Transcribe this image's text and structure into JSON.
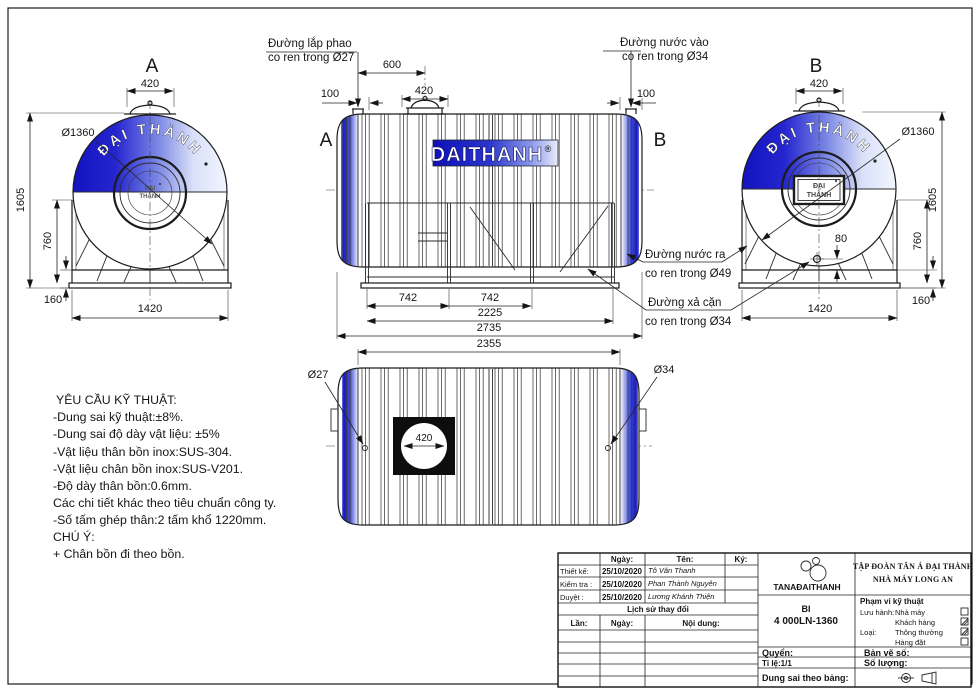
{
  "colors": {
    "brand_blue_dark": "#1212c0",
    "brand_blue_mid": "#3c46d8",
    "brand_blue_light": "#dfe6fb",
    "line": "#1c1c1c"
  },
  "views": {
    "side_a": {
      "letter": "A",
      "dim_manhole": "420",
      "dia_label": "Ø1360",
      "dim_height": "1605",
      "dim_stand": "760",
      "dim_base": "160",
      "dim_width": "1420",
      "arc_brand": "ĐẠI THÀNH",
      "hub_top": "ĐẠI",
      "hub_bottom": "THÀNH"
    },
    "side_b": {
      "letter": "B",
      "dim_manhole": "420",
      "dia_label": "Ø1360",
      "dim_height": "1605",
      "dim_stand": "760",
      "dim_base": "160",
      "dim_width": "1420",
      "dim_drain": "80",
      "arc_brand": "ĐẠI THÀNH",
      "hub_top": "ĐẠI",
      "hub_bottom": "THÀNH"
    },
    "elevation": {
      "letter_left": "A",
      "letter_right": "B",
      "dim_float": "600",
      "dim_left": "100",
      "dim_manhole": "420",
      "dim_right": "100",
      "dim_seg1": "742",
      "dim_seg2": "742",
      "dim_stand": "2225",
      "dim_total": "2735",
      "brand": "DAITHANH",
      "reg": "®"
    },
    "plan": {
      "dim_body": "2355",
      "dia_left": "Ø27",
      "dia_right": "Ø34",
      "dim_manhole": "420"
    }
  },
  "callouts": {
    "float_line1": "Đường lắp phao",
    "float_line2": "co ren trong Ø27",
    "inlet_line1": "Đường nước vào",
    "inlet_line2": "co ren trong Ø34",
    "outlet_line1": "Đường nước ra",
    "outlet_line2": "co ren trong Ø49",
    "drain_line1": "Đường xả cặn",
    "drain_line2": "co ren trong Ø34"
  },
  "tech_note": {
    "title": "YÊU CẦU KỸ THUẬT:",
    "items": [
      "-Dung sai kỹ thuật:±8%.",
      "-Dung sai độ dày vật liệu: ±5%",
      "-Vật liệu thân bồn inox:SUS-304.",
      "-Vật liệu chân bồn inox:SUS-V201.",
      "-Độ dày thân bồn:0.6mm.",
      "Các chi tiết khác theo tiêu chuẩn công ty.",
      "-Số tấm ghép thân:2 tấm khổ 1220mm."
    ],
    "attention": "CHÚ Ý:",
    "attention_items": [
      "+ Chân bồn đi theo bồn."
    ]
  },
  "title_block": {
    "approval": {
      "col_date": "Ngày:",
      "col_name": "Tên:",
      "col_sign": "Ký:",
      "row1_label": "Thiết kế:",
      "row1_date": "25/10/2020",
      "row1_name": "Tô Văn Thanh",
      "row2_label": "Kiểm tra :",
      "row2_date": "25/10/2020",
      "row2_name": "Phan Thành Nguyên",
      "row3_label": "Duyệt :",
      "row3_date": "25/10/2020",
      "row3_name": "Lương Khánh Thiện"
    },
    "history": {
      "title": "Lịch sử thay đổi",
      "col_no": "Lần:",
      "col_date": "Ngày:",
      "col_content": "Nội dung:"
    },
    "company": {
      "logo_text": "TANAĐAITHANH",
      "line1": "TẬP ĐOÀN TÂN Á ĐẠI THÀNH",
      "line2": "NHÀ MÁY LONG AN"
    },
    "model": {
      "series": "BI",
      "code": "4 000LN-1360"
    },
    "scope": {
      "title": "Phạm vi kỹ thuật",
      "release_label": "Lưu hành:",
      "opt1": "Nhà máy",
      "opt1_checked": false,
      "opt2": "Khách hàng",
      "opt2_checked": true,
      "type_label": "Loại:",
      "opt3": "Thông thường",
      "opt3_checked": true,
      "opt4": "Hàng đặt",
      "opt4_checked": false
    },
    "fields": {
      "book": "Quyển:",
      "drawing_no": "Bản vẽ số:",
      "scale": "Tỉ lệ:1/1",
      "quantity": "Số lượng:",
      "tolerance": "Dung sai theo bảng:"
    }
  }
}
